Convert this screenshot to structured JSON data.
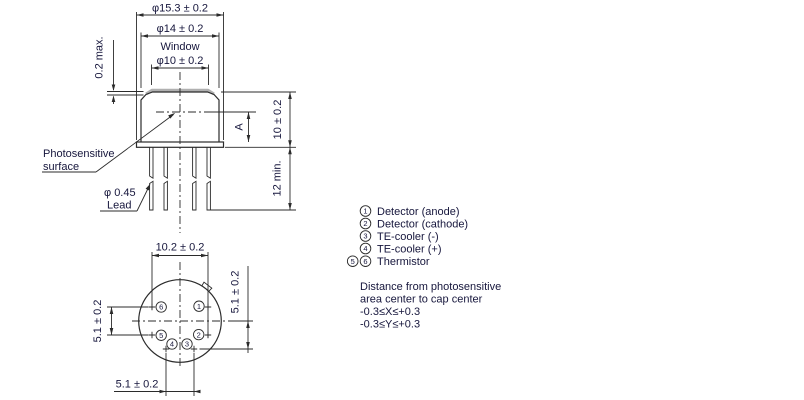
{
  "drawing_title": "TE-cooled photodetector package outline drawing",
  "colors": {
    "line": "#2b2b2b",
    "text": "#16163c",
    "window_gray": "#b0b0b0",
    "background": "#ffffff"
  },
  "side_view": {
    "dim_outer": "φ15.3 ± 0.2",
    "dim_cap": "φ14 ± 0.2",
    "window_line1": "Window",
    "window_line2": "φ10 ± 0.2",
    "dim_step": "0.2 max.",
    "dim_a": "A",
    "dim_height": "10 ± 0.2",
    "dim_lead_len": "12 min.",
    "photosensitive_line1": "Photosensitive",
    "photosensitive_line2": "surface",
    "lead_line1": "φ 0.45",
    "lead_line2": "Lead"
  },
  "bottom_view": {
    "dim_width": "10.2 ± 0.2",
    "dim_left": "5.1 ± 0.2",
    "dim_right": "5.1 ± 0.2",
    "dim_bottom": "5.1 ± 0.2",
    "pins": [
      "1",
      "2",
      "3",
      "4",
      "5",
      "6"
    ]
  },
  "legend": {
    "items": [
      {
        "markers": [
          "1"
        ],
        "label": "Detector (anode)"
      },
      {
        "markers": [
          "2"
        ],
        "label": "Detector (cathode)"
      },
      {
        "markers": [
          "3"
        ],
        "label": "TE-cooler (-)"
      },
      {
        "markers": [
          "4"
        ],
        "label": "TE-cooler (+)"
      },
      {
        "markers": [
          "5",
          "6"
        ],
        "label": "Thermistor"
      }
    ]
  },
  "note": {
    "line1": "Distance from photosensitive",
    "line2": "area center to cap center",
    "line3": "-0.3≤X≤+0.3",
    "line4": "-0.3≤Y≤+0.3"
  }
}
